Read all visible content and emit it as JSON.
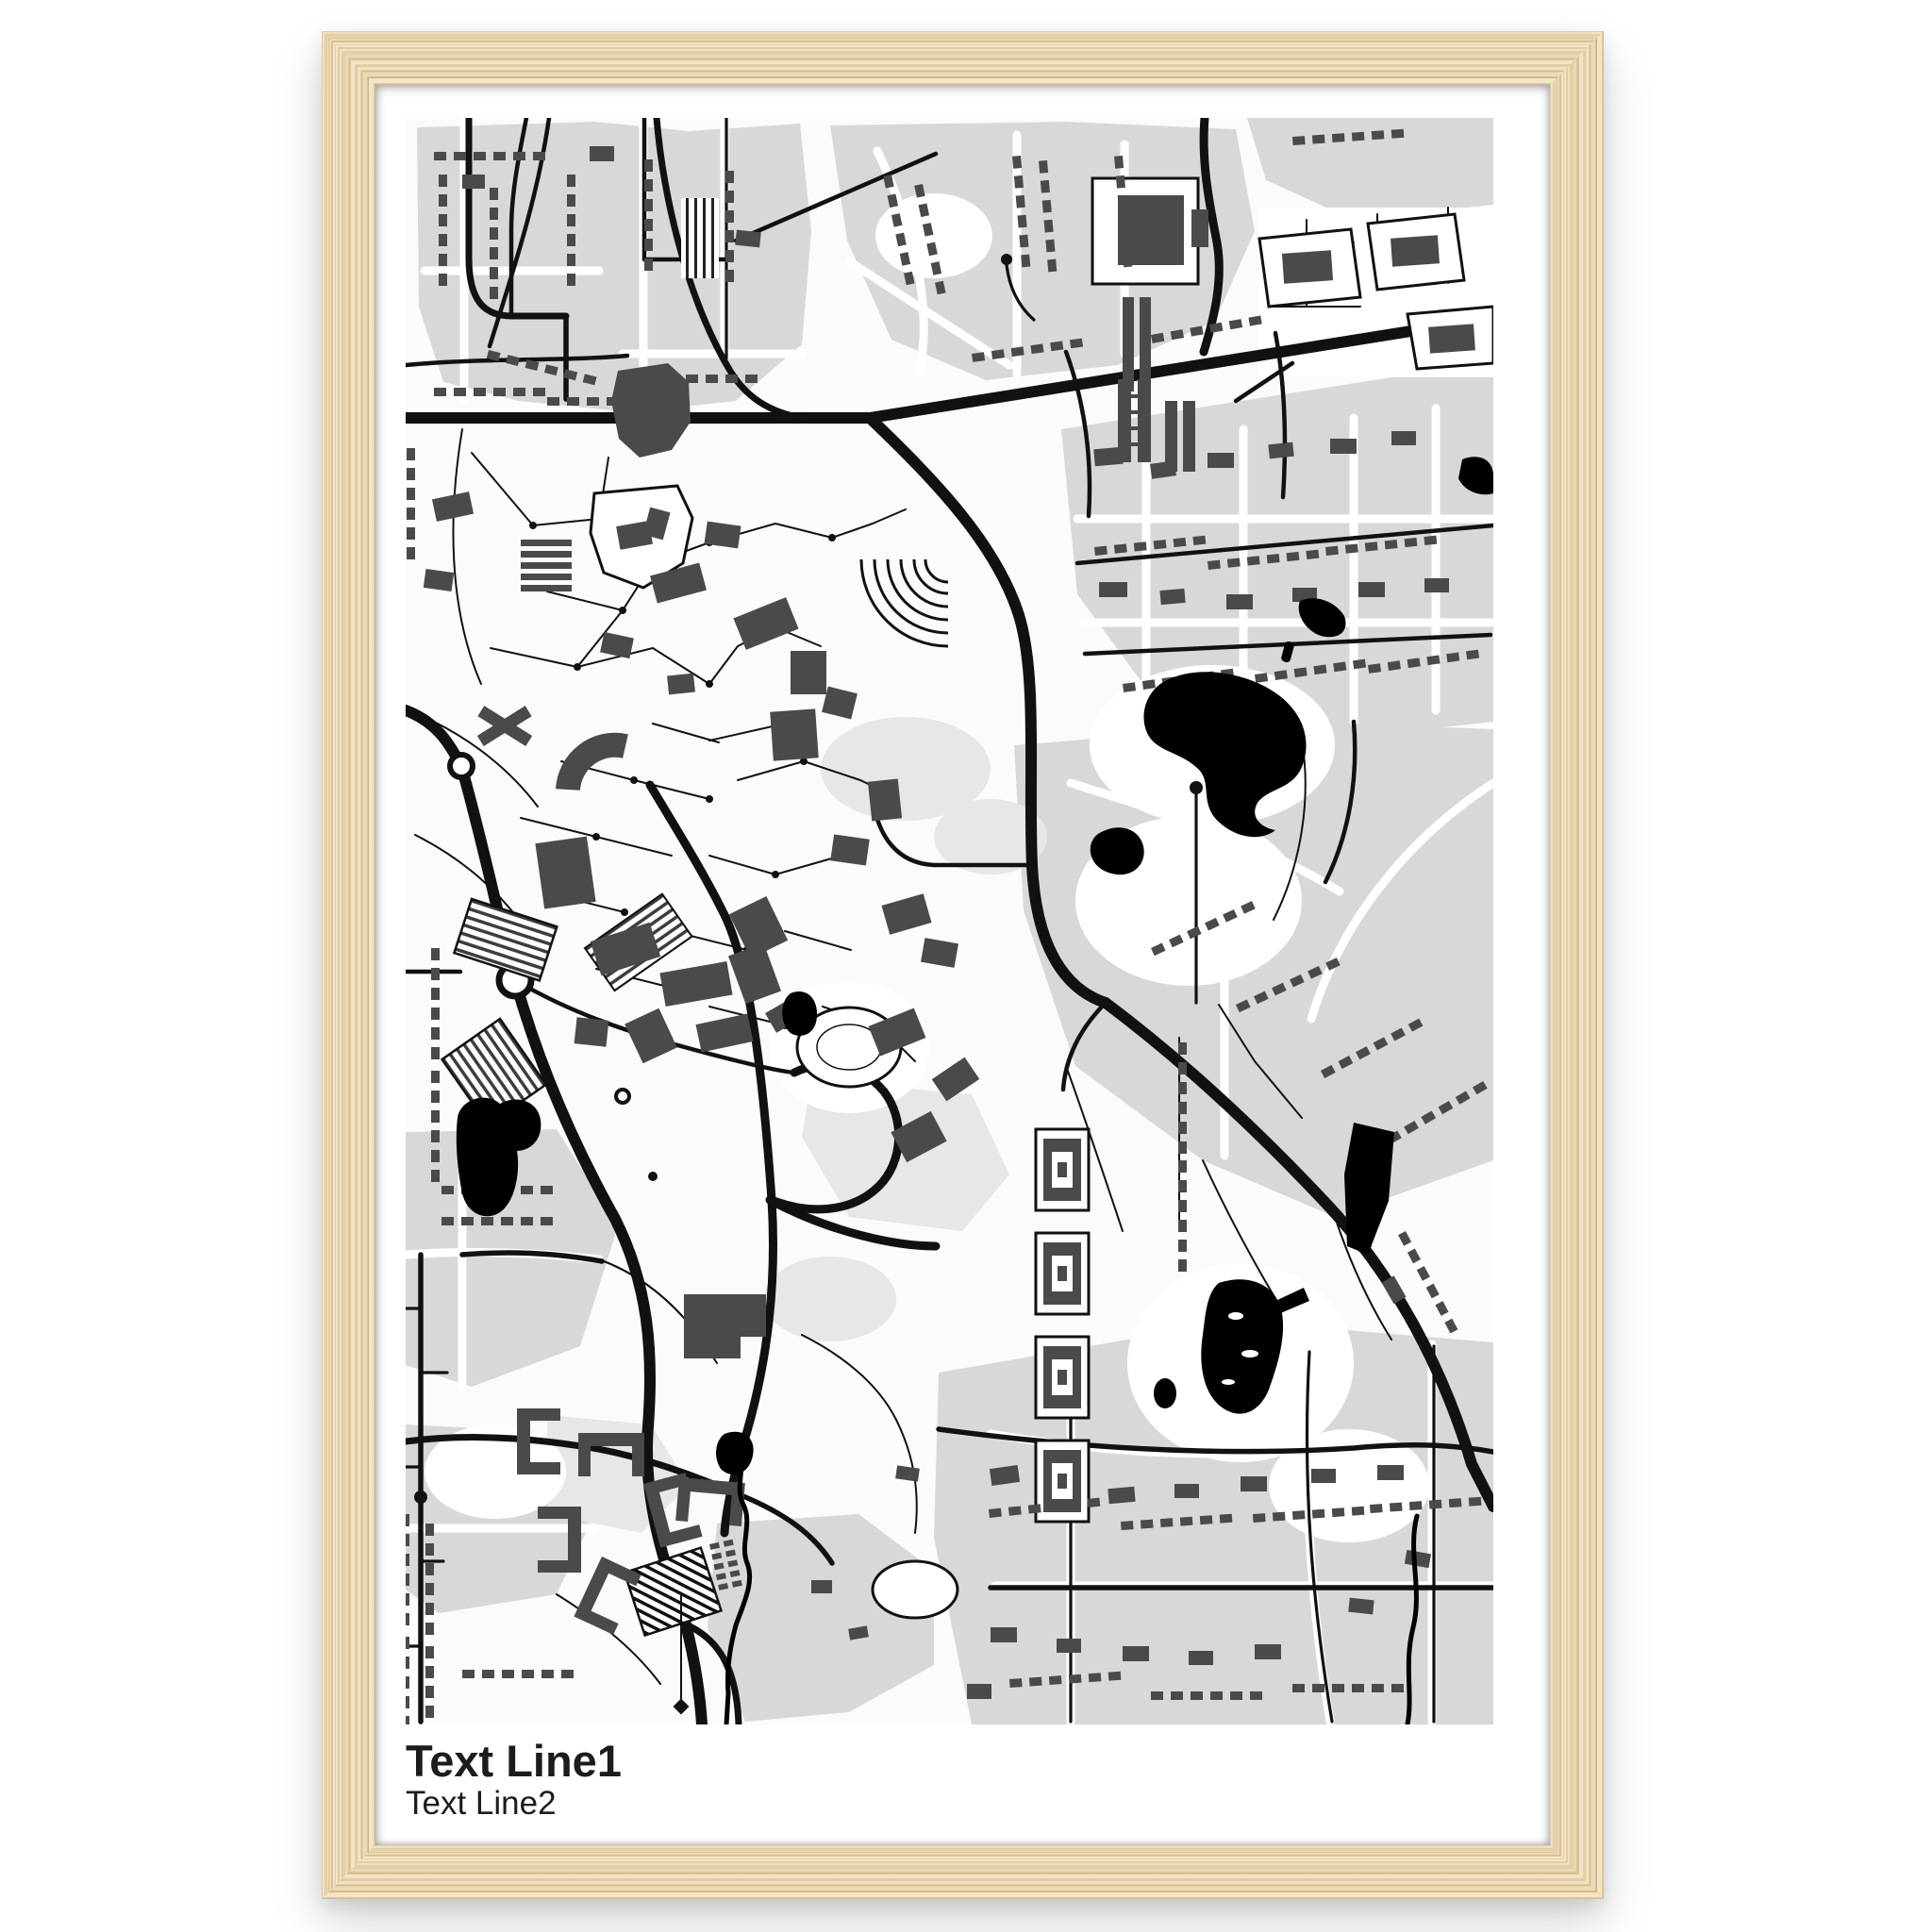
{
  "poster": {
    "title": "Text Line1",
    "subtitle": "Text Line2"
  },
  "frame": {
    "material": "light-wood",
    "frame_color": "#e9d5ae",
    "mat_color": "#ffffff"
  },
  "map": {
    "type": "black-and-white street map poster",
    "colors": {
      "background": "#fbfbfb",
      "urban_blocks": "#d8d8d8",
      "buildings": "#4a4a4a",
      "roads": "#111111",
      "water": "#000000"
    }
  }
}
